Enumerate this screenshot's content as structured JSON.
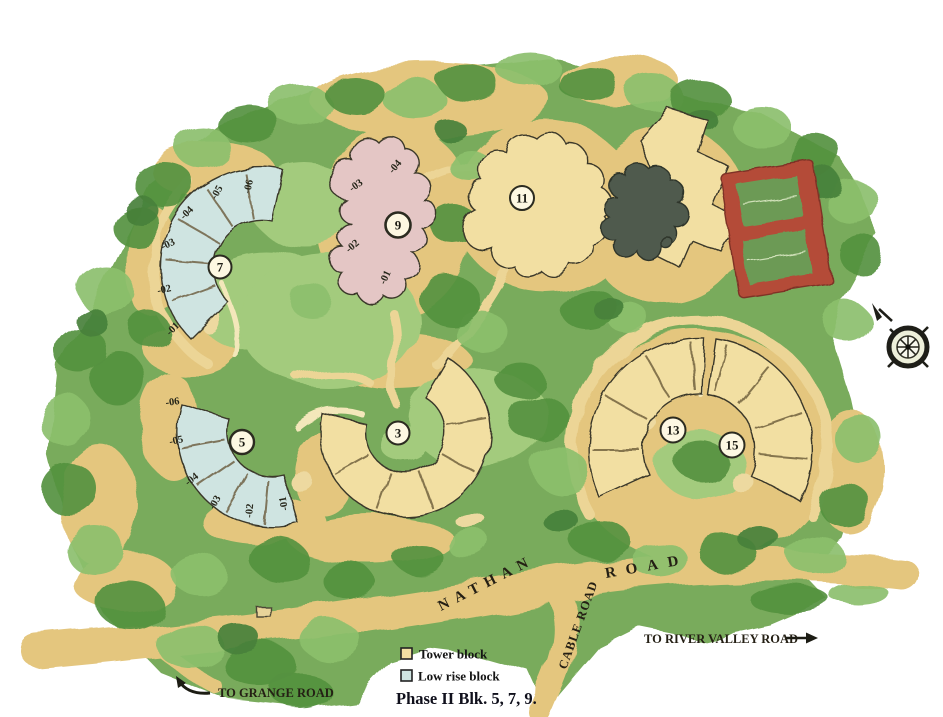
{
  "legend": {
    "tower_label": "Tower block",
    "low_rise_label": "Low rise block",
    "phase_note": "Phase II Blk. 5, 7, 9."
  },
  "roads": {
    "nathan": "NATHAN",
    "road_suffix": "ROAD",
    "cable": "CABLE ROAD",
    "to_river_valley": "TO RIVER VALLEY ROAD",
    "to_grange": "TO GRANGE ROAD"
  },
  "blocks": {
    "b3": {
      "num": "3",
      "type": "tower"
    },
    "b5": {
      "num": "5",
      "type": "low-rise",
      "units": [
        "-01",
        "-02",
        "-03",
        "-04",
        "-05",
        "-06"
      ]
    },
    "b7": {
      "num": "7",
      "type": "low-rise",
      "units": [
        "-01",
        "-02",
        "-03",
        "-04",
        "-05",
        "-06"
      ]
    },
    "b9": {
      "num": "9",
      "type": "low-rise",
      "units": [
        "-01",
        "-02",
        "-03",
        "-04"
      ]
    },
    "b11": {
      "num": "11",
      "type": "tower"
    },
    "b13": {
      "num": "13",
      "type": "tower"
    },
    "b15": {
      "num": "15",
      "type": "tower"
    }
  },
  "colors": {
    "tower": "#f2dfa2",
    "low_rise": "#cfe4e1",
    "phase2_block9": "#e4c6c5",
    "forest": "#79ab5b",
    "forest_dark": "#55913f",
    "forest_light": "#8cbf6d",
    "lawn": "#a3cb7d",
    "road": "#e4c67e",
    "sand": "#edd9a0",
    "tennis_red": "#b44b38",
    "tennis_green": "#6c9a55",
    "pond": "#4f5a4e",
    "badge_fill": "#fdf8e2",
    "outline": "#3a382a"
  }
}
